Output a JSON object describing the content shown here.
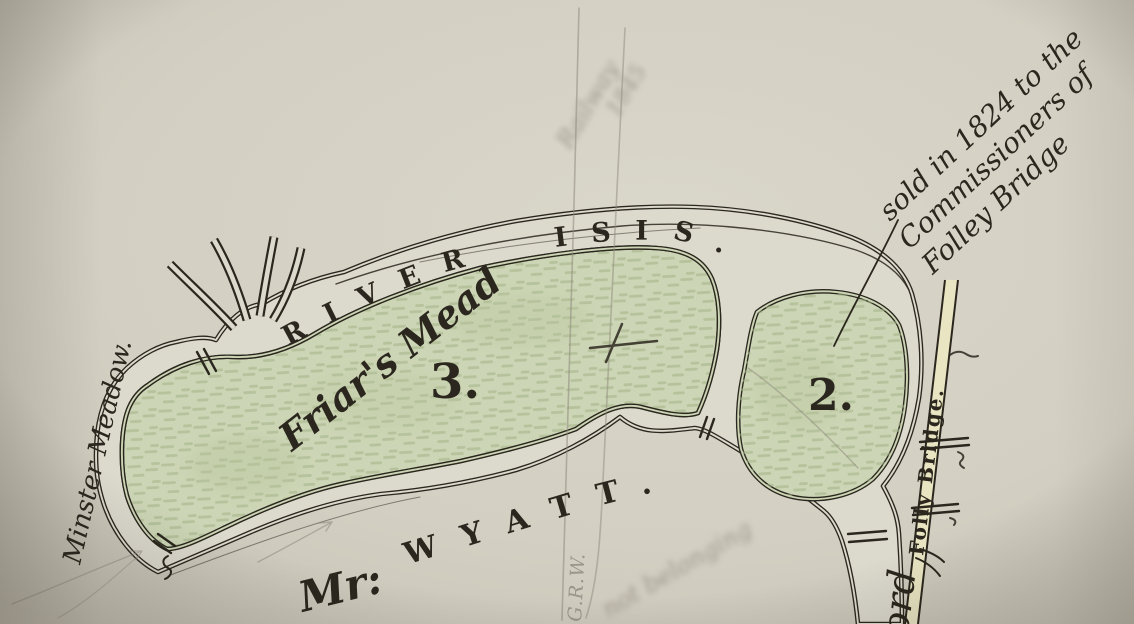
{
  "labels": {
    "river": "RIVER ISIS.",
    "meadow": "Friar's Mead",
    "parcel_3": "3.",
    "parcel_2": "2.",
    "minster_meadow": "Minster Meadow.",
    "owner_prefix": "Mr:",
    "owner_name": "WYATT.",
    "folly_bridge": "Folly Bridge.",
    "ford": "ford"
  },
  "annotations": {
    "sold_note": [
      "sold in 1824 to the",
      "Commissioners of",
      "Folley Bridge"
    ],
    "railway": "Railway",
    "railway_year": "1845",
    "initials": "G.R.W.",
    "pencil_note": "not belonging"
  },
  "colors": {
    "paper": "#d3cfc2",
    "ink": "#2b271e",
    "pencil": "#8e897b",
    "meadow_green": "#ccd5b5",
    "meadow_texture": "#a2b386",
    "river_water": "#dcd9cd",
    "road_fill": "#e9e5c3"
  }
}
